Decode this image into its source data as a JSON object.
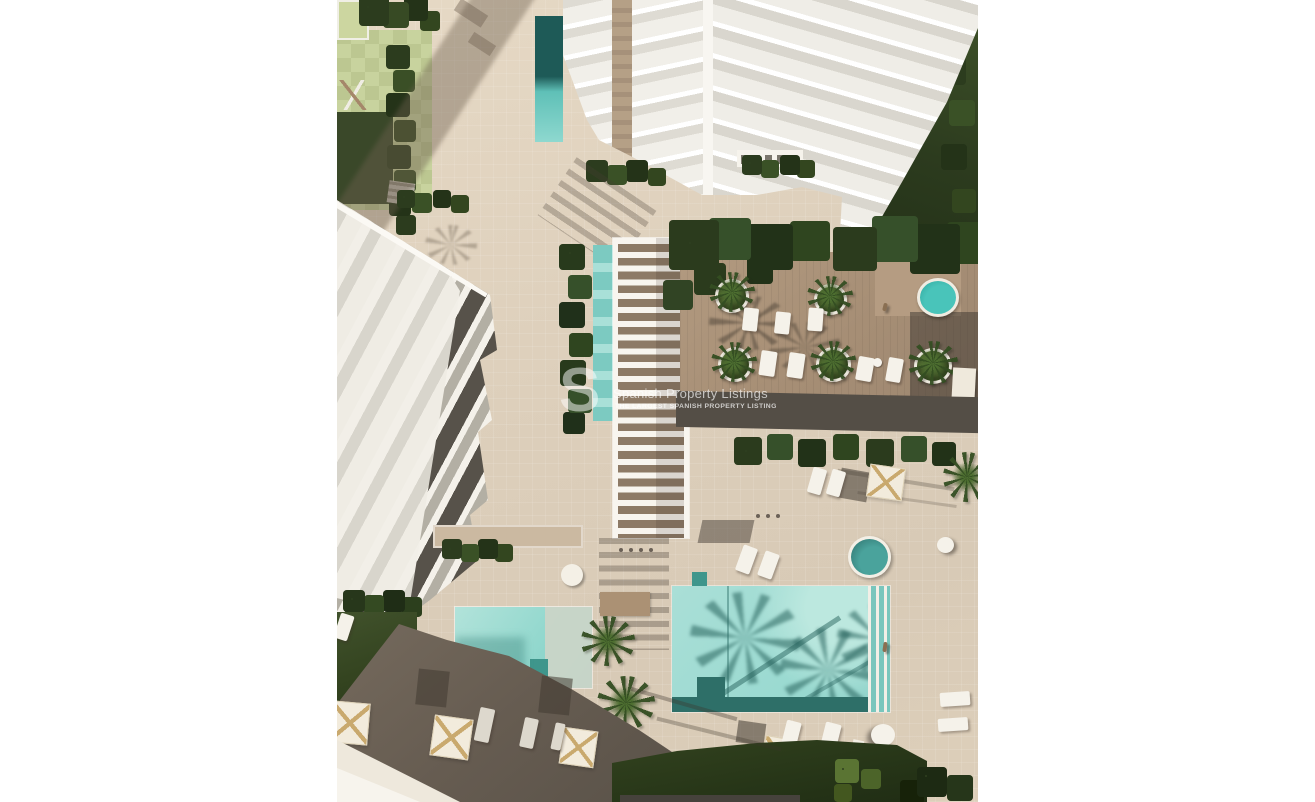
{
  "image": {
    "type": "aerial-3d-architectural-render",
    "subject": "Top-down view of a residential resort complex with apartment tower, townhouse block, pergola walkway, wooden spa deck and swimming pools"
  },
  "watermark": {
    "logo_letter": "S",
    "title": "Spanish Property Listings",
    "subtitle": "THE LARGEST SPANISH PROPERTY LISTING"
  },
  "palette": {
    "margin_white": "#ffffff",
    "paving_beige": "#ddcfbb",
    "paving_light": "#e6d9c5",
    "pool_teal_light": "#a9ded6",
    "pool_teal_shadow": "#4f9a94",
    "pool_teal_deep": "#2e6f68",
    "deck_wood": "#a68e75",
    "lawn_light_green": "#c8d39e",
    "lawn_dark_green": "#3a4829",
    "tree_green": "#2f4020",
    "building_white": "#f4f1ea",
    "facade_charcoal": "#57524a",
    "hard_shadow": "#5b544c",
    "watermark_white_alpha": "rgba(255,255,255,0.6)"
  }
}
